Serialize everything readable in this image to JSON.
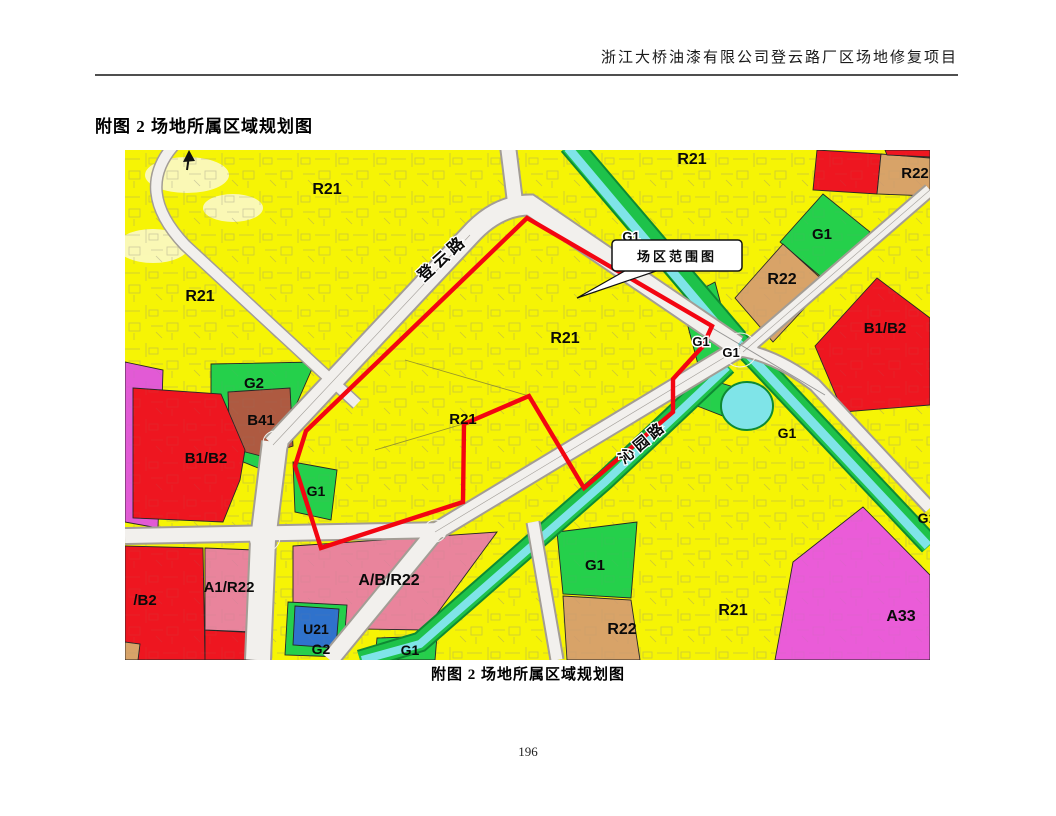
{
  "page": {
    "header_title": "浙江大桥油漆有限公司登云路厂区场地修复项目",
    "figure_title": "附图 2 场地所属区域规划图",
    "caption": "附图 2 场地所属区域规划图",
    "page_number": "196"
  },
  "map": {
    "callout_label": "场区范围图",
    "road_names": [
      {
        "text": "登云路",
        "x": 321,
        "y": 112,
        "rotate": -42,
        "size": 16
      },
      {
        "text": "沁园路",
        "x": 521,
        "y": 296,
        "rotate": -40,
        "size": 15
      }
    ],
    "zone_labels": [
      {
        "text": "R21",
        "x": 202,
        "y": 44,
        "size": 16
      },
      {
        "text": "R21",
        "x": 567,
        "y": 14,
        "size": 16
      },
      {
        "text": "R22",
        "x": 790,
        "y": 28,
        "size": 15
      },
      {
        "text": "G1",
        "x": 697,
        "y": 89,
        "size": 15
      },
      {
        "text": "R22",
        "x": 657,
        "y": 134,
        "size": 16
      },
      {
        "text": "B1/B2",
        "x": 760,
        "y": 183,
        "size": 15
      },
      {
        "text": "R21",
        "x": 75,
        "y": 151,
        "size": 16
      },
      {
        "text": "R21",
        "x": 440,
        "y": 193,
        "size": 16
      },
      {
        "text": "G1",
        "x": 506,
        "y": 91,
        "size": 13,
        "halo": true
      },
      {
        "text": "G1",
        "x": 553,
        "y": 103,
        "size": 13,
        "halo": true
      },
      {
        "text": "R21",
        "x": 338,
        "y": 274,
        "size": 15
      },
      {
        "text": "G1",
        "x": 576,
        "y": 196,
        "size": 13,
        "halo": true
      },
      {
        "text": "G1",
        "x": 606,
        "y": 207,
        "size": 13,
        "halo": true
      },
      {
        "text": "G2",
        "x": 129,
        "y": 238,
        "size": 15
      },
      {
        "text": "B41",
        "x": 136,
        "y": 275,
        "size": 15
      },
      {
        "text": "B1/B2",
        "x": 81,
        "y": 313,
        "size": 15
      },
      {
        "text": "G1",
        "x": 191,
        "y": 346,
        "size": 14
      },
      {
        "text": "G1",
        "x": 662,
        "y": 288,
        "size": 14
      },
      {
        "text": "/B2",
        "x": 20,
        "y": 455,
        "size": 15
      },
      {
        "text": "A1/R22",
        "x": 104,
        "y": 442,
        "size": 15
      },
      {
        "text": "A/B/R22",
        "x": 264,
        "y": 435,
        "size": 16
      },
      {
        "text": "U21",
        "x": 191,
        "y": 484,
        "size": 14
      },
      {
        "text": "G2",
        "x": 196,
        "y": 504,
        "size": 14
      },
      {
        "text": "G1",
        "x": 285,
        "y": 505,
        "size": 14
      },
      {
        "text": "G1",
        "x": 470,
        "y": 420,
        "size": 15
      },
      {
        "text": "R22",
        "x": 497,
        "y": 484,
        "size": 16
      },
      {
        "text": "R21",
        "x": 608,
        "y": 465,
        "size": 16
      },
      {
        "text": "A33",
        "x": 776,
        "y": 471,
        "size": 16
      },
      {
        "text": "G1",
        "x": 802,
        "y": 373,
        "size": 14
      }
    ],
    "legend_colors": {
      "residential_R21_yellow": "#f6f405",
      "residential_R22_tan": "#d8a368",
      "green_space_G": "#25d04b",
      "commercial_B_red": "#ee1620",
      "commercial_B41_brown": "#ae5a41",
      "mixed_AB_pink": "#e9849c",
      "public_A33_magenta": "#ea5cd8",
      "utility_U21_blue": "#2f72cc",
      "water_channel_cyan": "#7fe4e8",
      "site_boundary_red": "#f30511"
    }
  }
}
